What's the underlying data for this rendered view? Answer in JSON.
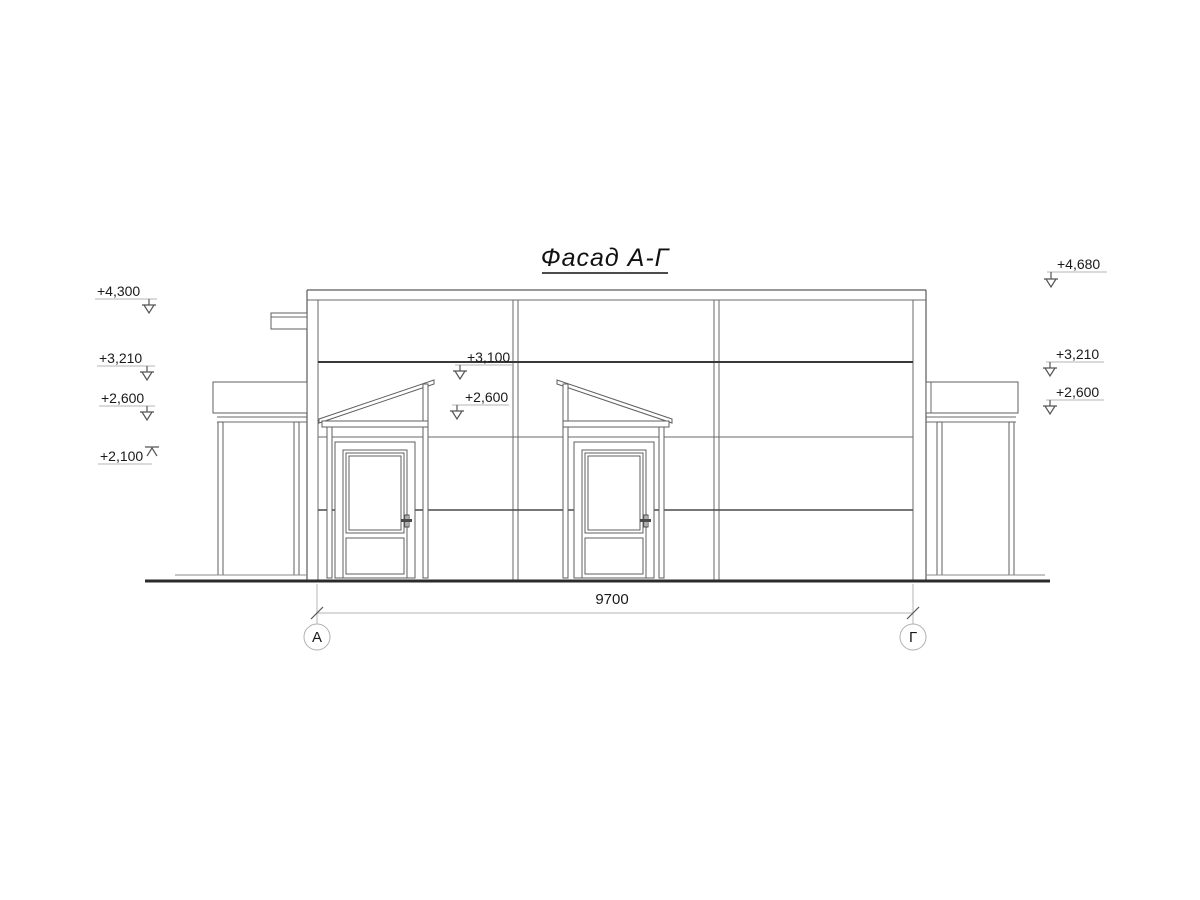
{
  "title": "Фасад А-Г",
  "dimension_label": "9700",
  "axes": {
    "left": "А",
    "right": "Г"
  },
  "marks": {
    "left": [
      "+4,300",
      "+3,210",
      "+2,600",
      "+2,100"
    ],
    "middle": [
      "+3,100",
      "+2,600"
    ],
    "right": [
      "+4,680",
      "+3,210",
      "+2,600"
    ]
  },
  "colors": {
    "background": "#ffffff",
    "line": "#6a6a6a",
    "dark_line": "#383838",
    "leader_line": "#b5b5b5",
    "text": "#1a1a1a"
  }
}
